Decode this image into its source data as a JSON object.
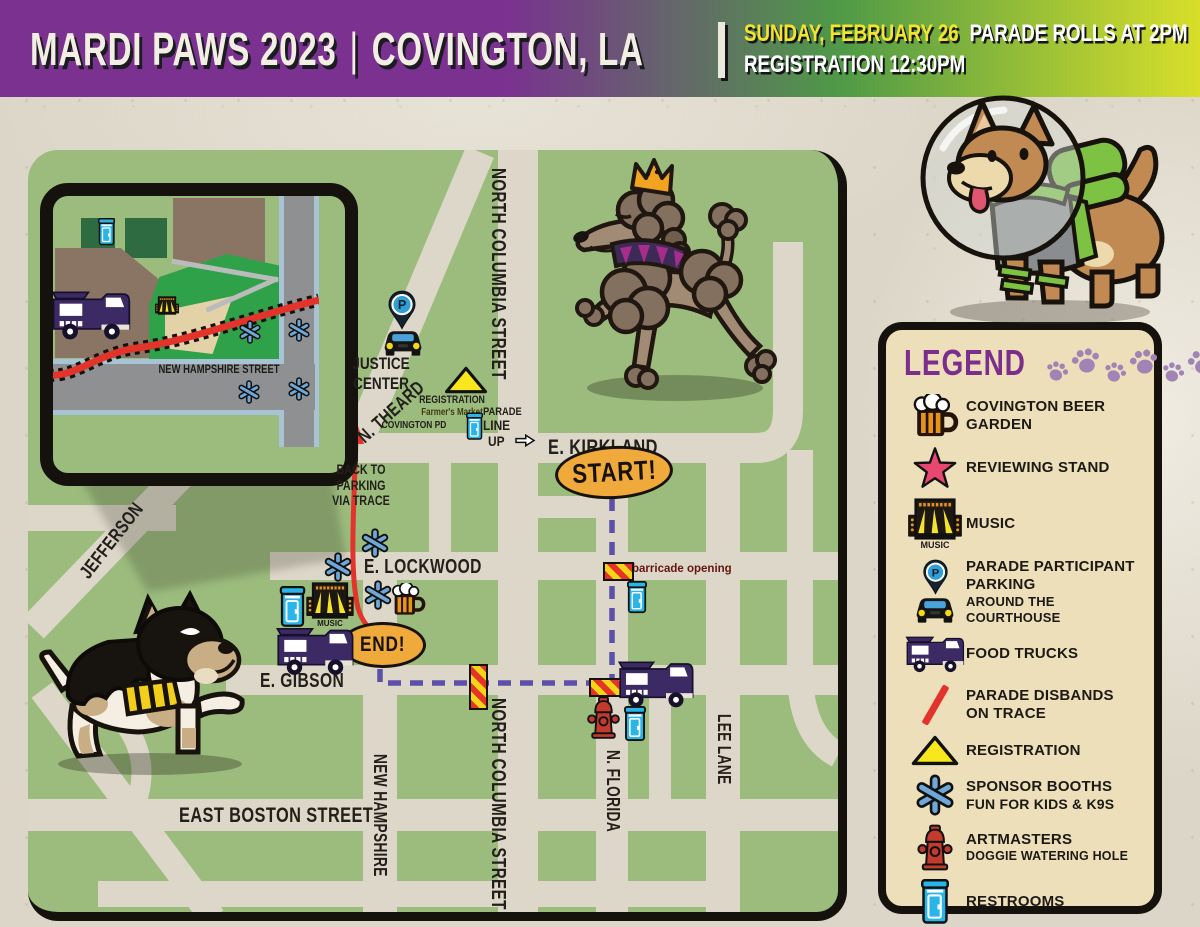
{
  "header": {
    "title_event": "MARDI PAWS 2023",
    "title_separator": "|",
    "title_city": "COVINGTON, LA",
    "date": "SUNDAY, FEBRUARY 26",
    "parade_rolls": "PARADE ROLLS AT 2PM",
    "registration": "REGISTRATION 12:30PM"
  },
  "map": {
    "streets": {
      "north_columbia": "NORTH COLUMBIA STREET",
      "n_theard": "N. THEARD",
      "jefferson": "JEFFERSON",
      "e_kirkland": "E. KIRKLAND",
      "e_lockwood": "E. LOCKWOOD",
      "e_gibson": "E. GIBSON",
      "east_boston": "EAST BOSTON STREET",
      "new_hampshire": "NEW HAMPSHIRE",
      "n_florida": "N. FLORIDA",
      "lee_lane": "LEE LANE"
    },
    "labels": {
      "justice_center": [
        "JUSTICE",
        "CENTER"
      ],
      "registration": "REGISTRATION",
      "farmers_market": "Farmer's Market",
      "covington_pd": "COVINGTON PD",
      "parade_line_up": [
        "PARADE",
        "LINE",
        "UP"
      ],
      "start": "START!",
      "end": "END!",
      "barricade_opening": "barricade opening",
      "back_to_parking": [
        "BACK TO",
        "PARKING",
        "VIA TRACE"
      ],
      "music_caption": "MUSIC",
      "parking_pin_letter": "P"
    },
    "inset": {
      "street": "NEW HAMPSHIRE STREET"
    }
  },
  "legend": {
    "title": "LEGEND",
    "items": [
      {
        "icon": "beer-mug-icon",
        "label": "COVINGTON BEER GARDEN"
      },
      {
        "icon": "star-icon",
        "label": "REVIEWING STAND"
      },
      {
        "icon": "music-stage-icon",
        "label": "MUSIC",
        "icon_caption": "MUSIC"
      },
      {
        "icon": "parking-pin-car-icon",
        "label": "PARADE PARTICIPANT PARKING",
        "label2": "AROUND THE COURTHOUSE"
      },
      {
        "icon": "food-truck-icon",
        "label": "FOOD TRUCKS"
      },
      {
        "icon": "red-line-icon",
        "label": "PARADE DISBANDS",
        "label2": "ON TRACE"
      },
      {
        "icon": "registration-triangle-icon",
        "label": "REGISTRATION"
      },
      {
        "icon": "sponsor-asterisk-icon",
        "label": "SPONSOR BOOTHS",
        "label2": "FUN FOR KIDS & K9S"
      },
      {
        "icon": "fire-hydrant-icon",
        "label": "ARTMASTERS",
        "label2": "DOGGIE WATERING HOLE"
      },
      {
        "icon": "restroom-icon",
        "label": "RESTROOMS"
      }
    ]
  },
  "colors": {
    "header_purple": "#7a3190",
    "header_green": "#4f9a47",
    "header_yellow": "#d8df2a",
    "date_yellow": "#f2e42f",
    "map_green": "#9cbc7e",
    "road": "#dcd7c8",
    "route_purple": "#5c50a8",
    "trace_red": "#e2342b",
    "marker_orange": "#f0a93b",
    "legend_bg": "#ecdfba",
    "legend_purple": "#7c2e8c",
    "paw_purple": "#a184b5",
    "sponsor_blue": "#6fa8d6"
  }
}
